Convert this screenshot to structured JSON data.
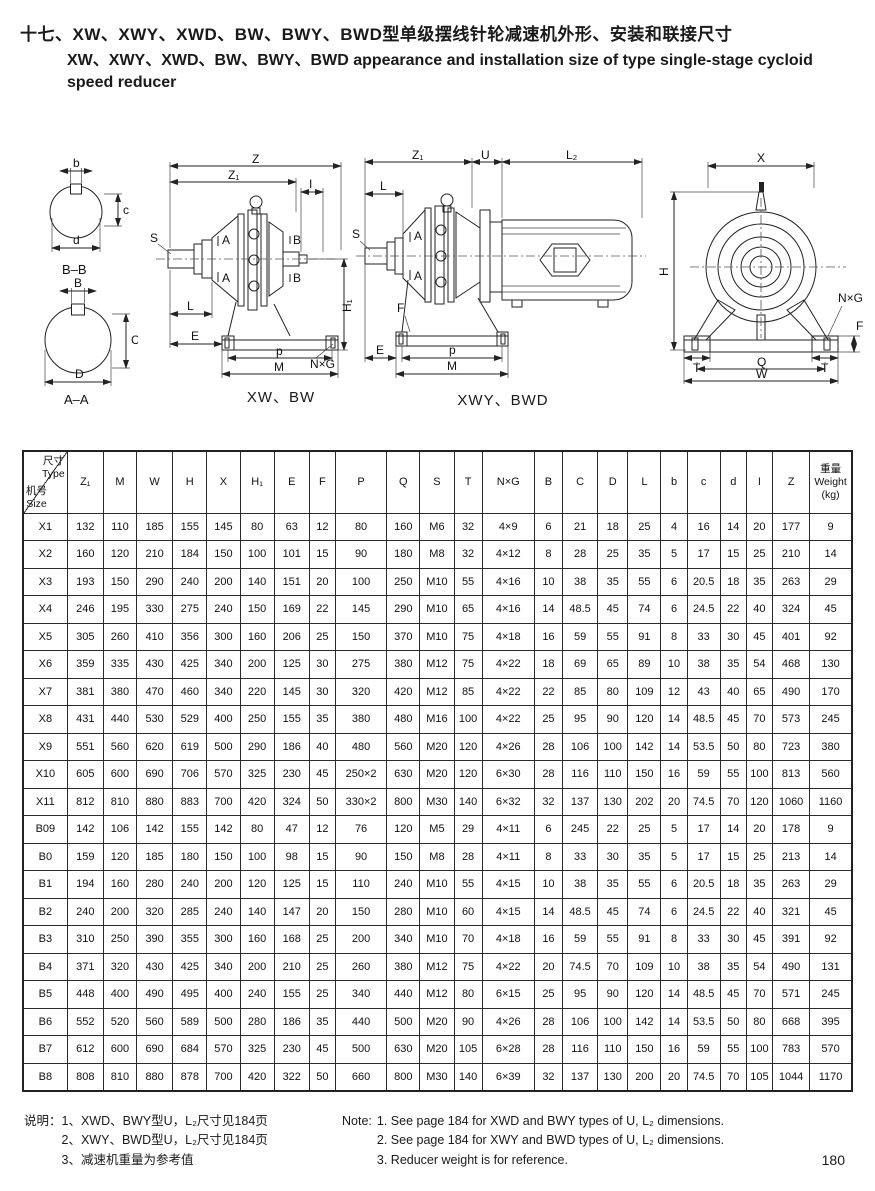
{
  "colors": {
    "ink": "#1a1a1a",
    "background": "#ffffff"
  },
  "title": {
    "line1_cn": "十七、XW、XWY、XWD、BW、BWY、BWD型单级摆线针轮减速机外形、安装和联接尺寸",
    "line2_en": "XW、XWY、XWD、BW、BWY、BWD appearance and installation size of type single-stage cycloid",
    "line3_en": "speed reducer"
  },
  "drawings": {
    "section_bb": {
      "top": "b",
      "side": "c",
      "bottom": "d",
      "caption": "B–B"
    },
    "section_aa": {
      "top": "B",
      "side": "C",
      "bottom": "D",
      "caption": "A–A"
    },
    "xw_bw": {
      "z": "Z",
      "z1": "Z₁",
      "i": "I",
      "s": "S",
      "a": "A",
      "b": "B",
      "l": "L",
      "e": "E",
      "p": "p",
      "m": "M",
      "h1": "H₁",
      "nxg": "N×G",
      "caption": "XW、BW"
    },
    "xwy_bwd": {
      "z1": "Z₁",
      "u": "U",
      "l2": "L₂",
      "s": "S",
      "l": "L",
      "a": "A",
      "f": "F",
      "e": "E",
      "p": "p",
      "m": "M",
      "caption": "XWY、BWD"
    },
    "front": {
      "x": "X",
      "h": "H",
      "nxg": "N×G",
      "f": "F",
      "t": "T",
      "q": "Q",
      "w": "W"
    }
  },
  "table": {
    "corner": {
      "top_cn": "尺寸",
      "top_en": "Type",
      "bottom_cn": "机号",
      "bottom_en": "Size"
    },
    "columns": [
      "Z₁",
      "M",
      "W",
      "H",
      "X",
      "H₁",
      "E",
      "F",
      "P",
      "Q",
      "S",
      "T",
      "N×G",
      "B",
      "C",
      "D",
      "L",
      "b",
      "c",
      "d",
      "I",
      "Z"
    ],
    "weight_header": [
      "重量",
      "Weight",
      "(kg)"
    ],
    "rows": [
      {
        "size": "X1",
        "values": [
          "132",
          "110",
          "185",
          "155",
          "145",
          "80",
          "63",
          "12",
          "80",
          "160",
          "M6",
          "32",
          "4×9",
          "6",
          "21",
          "18",
          "25",
          "4",
          "16",
          "14",
          "20",
          "177",
          "9"
        ]
      },
      {
        "size": "X2",
        "values": [
          "160",
          "120",
          "210",
          "184",
          "150",
          "100",
          "101",
          "15",
          "90",
          "180",
          "M8",
          "32",
          "4×12",
          "8",
          "28",
          "25",
          "35",
          "5",
          "17",
          "15",
          "25",
          "210",
          "14"
        ]
      },
      {
        "size": "X3",
        "values": [
          "193",
          "150",
          "290",
          "240",
          "200",
          "140",
          "151",
          "20",
          "100",
          "250",
          "M10",
          "55",
          "4×16",
          "10",
          "38",
          "35",
          "55",
          "6",
          "20.5",
          "18",
          "35",
          "263",
          "29"
        ]
      },
      {
        "size": "X4",
        "values": [
          "246",
          "195",
          "330",
          "275",
          "240",
          "150",
          "169",
          "22",
          "145",
          "290",
          "M10",
          "65",
          "4×16",
          "14",
          "48.5",
          "45",
          "74",
          "6",
          "24.5",
          "22",
          "40",
          "324",
          "45"
        ]
      },
      {
        "size": "X5",
        "values": [
          "305",
          "260",
          "410",
          "356",
          "300",
          "160",
          "206",
          "25",
          "150",
          "370",
          "M10",
          "75",
          "4×18",
          "16",
          "59",
          "55",
          "91",
          "8",
          "33",
          "30",
          "45",
          "401",
          "92"
        ]
      },
      {
        "size": "X6",
        "values": [
          "359",
          "335",
          "430",
          "425",
          "340",
          "200",
          "125",
          "30",
          "275",
          "380",
          "M12",
          "75",
          "4×22",
          "18",
          "69",
          "65",
          "89",
          "10",
          "38",
          "35",
          "54",
          "468",
          "130"
        ]
      },
      {
        "size": "X7",
        "values": [
          "381",
          "380",
          "470",
          "460",
          "340",
          "220",
          "145",
          "30",
          "320",
          "420",
          "M12",
          "85",
          "4×22",
          "22",
          "85",
          "80",
          "109",
          "12",
          "43",
          "40",
          "65",
          "490",
          "170"
        ]
      },
      {
        "size": "X8",
        "values": [
          "431",
          "440",
          "530",
          "529",
          "400",
          "250",
          "155",
          "35",
          "380",
          "480",
          "M16",
          "100",
          "4×22",
          "25",
          "95",
          "90",
          "120",
          "14",
          "48.5",
          "45",
          "70",
          "573",
          "245"
        ]
      },
      {
        "size": "X9",
        "values": [
          "551",
          "560",
          "620",
          "619",
          "500",
          "290",
          "186",
          "40",
          "480",
          "560",
          "M20",
          "120",
          "4×26",
          "28",
          "106",
          "100",
          "142",
          "14",
          "53.5",
          "50",
          "80",
          "723",
          "380"
        ]
      },
      {
        "size": "X10",
        "values": [
          "605",
          "600",
          "690",
          "706",
          "570",
          "325",
          "230",
          "45",
          "250×2",
          "630",
          "M20",
          "120",
          "6×30",
          "28",
          "116",
          "110",
          "150",
          "16",
          "59",
          "55",
          "100",
          "813",
          "560"
        ]
      },
      {
        "size": "X11",
        "values": [
          "812",
          "810",
          "880",
          "883",
          "700",
          "420",
          "324",
          "50",
          "330×2",
          "800",
          "M30",
          "140",
          "6×32",
          "32",
          "137",
          "130",
          "202",
          "20",
          "74.5",
          "70",
          "120",
          "1060",
          "1160"
        ]
      },
      {
        "size": "B09",
        "values": [
          "142",
          "106",
          "142",
          "155",
          "142",
          "80",
          "47",
          "12",
          "76",
          "120",
          "M5",
          "29",
          "4×11",
          "6",
          "245",
          "22",
          "25",
          "5",
          "17",
          "14",
          "20",
          "178",
          "9"
        ]
      },
      {
        "size": "B0",
        "values": [
          "159",
          "120",
          "185",
          "180",
          "150",
          "100",
          "98",
          "15",
          "90",
          "150",
          "M8",
          "28",
          "4×11",
          "8",
          "33",
          "30",
          "35",
          "5",
          "17",
          "15",
          "25",
          "213",
          "14"
        ]
      },
      {
        "size": "B1",
        "values": [
          "194",
          "160",
          "280",
          "240",
          "200",
          "120",
          "125",
          "15",
          "110",
          "240",
          "M10",
          "55",
          "4×15",
          "10",
          "38",
          "35",
          "55",
          "6",
          "20.5",
          "18",
          "35",
          "263",
          "29"
        ]
      },
      {
        "size": "B2",
        "values": [
          "240",
          "200",
          "320",
          "285",
          "240",
          "140",
          "147",
          "20",
          "150",
          "280",
          "M10",
          "60",
          "4×15",
          "14",
          "48.5",
          "45",
          "74",
          "6",
          "24.5",
          "22",
          "40",
          "321",
          "45"
        ]
      },
      {
        "size": "B3",
        "values": [
          "310",
          "250",
          "390",
          "355",
          "300",
          "160",
          "168",
          "25",
          "200",
          "340",
          "M10",
          "70",
          "4×18",
          "16",
          "59",
          "55",
          "91",
          "8",
          "33",
          "30",
          "45",
          "391",
          "92"
        ]
      },
      {
        "size": "B4",
        "values": [
          "371",
          "320",
          "430",
          "425",
          "340",
          "200",
          "210",
          "25",
          "260",
          "380",
          "M12",
          "75",
          "4×22",
          "20",
          "74.5",
          "70",
          "109",
          "10",
          "38",
          "35",
          "54",
          "490",
          "131"
        ]
      },
      {
        "size": "B5",
        "values": [
          "448",
          "400",
          "490",
          "495",
          "400",
          "240",
          "155",
          "25",
          "340",
          "440",
          "M12",
          "80",
          "6×15",
          "25",
          "95",
          "90",
          "120",
          "14",
          "48.5",
          "45",
          "70",
          "571",
          "245"
        ]
      },
      {
        "size": "B6",
        "values": [
          "552",
          "520",
          "560",
          "589",
          "500",
          "280",
          "186",
          "35",
          "440",
          "500",
          "M20",
          "90",
          "4×26",
          "28",
          "106",
          "100",
          "142",
          "14",
          "53.5",
          "50",
          "80",
          "668",
          "395"
        ]
      },
      {
        "size": "B7",
        "values": [
          "612",
          "600",
          "690",
          "684",
          "570",
          "325",
          "230",
          "45",
          "500",
          "630",
          "M20",
          "105",
          "6×28",
          "28",
          "116",
          "110",
          "150",
          "16",
          "59",
          "55",
          "100",
          "783",
          "570"
        ]
      },
      {
        "size": "B8",
        "values": [
          "808",
          "810",
          "880",
          "878",
          "700",
          "420",
          "322",
          "50",
          "660",
          "800",
          "M30",
          "140",
          "6×39",
          "32",
          "137",
          "130",
          "200",
          "20",
          "74.5",
          "70",
          "105",
          "1044",
          "1170"
        ]
      }
    ]
  },
  "notes_cn": {
    "label": "说明：",
    "items": [
      "1、XWD、BWY型U，L₂尺寸见184页",
      "2、XWY、BWD型U，L₂尺寸见184页",
      "3、减速机重量为参考值"
    ]
  },
  "notes_en": {
    "label": "Note:",
    "items": [
      "1. See page 184 for XWD and BWY types of U, L₂ dimensions.",
      "2. See page 184 for XWY and BWD types of U, L₂ dimensions.",
      "3. Reducer weight is for reference."
    ]
  },
  "page_number": "180"
}
